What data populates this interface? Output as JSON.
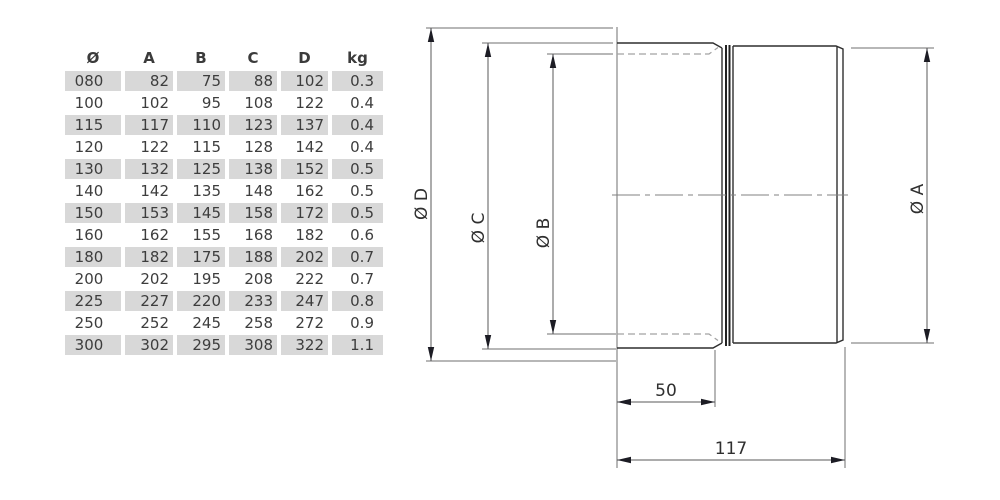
{
  "table": {
    "columns": [
      "Ø",
      "A",
      "B",
      "C",
      "D",
      "kg"
    ],
    "rows": [
      [
        "080",
        "82",
        "75",
        "88",
        "102",
        "0.3"
      ],
      [
        "100",
        "102",
        "95",
        "108",
        "122",
        "0.4"
      ],
      [
        "115",
        "117",
        "110",
        "123",
        "137",
        "0.4"
      ],
      [
        "120",
        "122",
        "115",
        "128",
        "142",
        "0.4"
      ],
      [
        "130",
        "132",
        "125",
        "138",
        "152",
        "0.5"
      ],
      [
        "140",
        "142",
        "135",
        "148",
        "162",
        "0.5"
      ],
      [
        "150",
        "153",
        "145",
        "158",
        "172",
        "0.5"
      ],
      [
        "160",
        "162",
        "155",
        "168",
        "182",
        "0.6"
      ],
      [
        "180",
        "182",
        "175",
        "188",
        "202",
        "0.7"
      ],
      [
        "200",
        "202",
        "195",
        "208",
        "222",
        "0.7"
      ],
      [
        "225",
        "227",
        "220",
        "233",
        "247",
        "0.8"
      ],
      [
        "250",
        "252",
        "245",
        "258",
        "272",
        "0.9"
      ],
      [
        "300",
        "302",
        "295",
        "308",
        "322",
        "1.1"
      ]
    ]
  },
  "drawing": {
    "labels": {
      "d": "Ø D",
      "c": "Ø C",
      "b": "Ø B",
      "a": "Ø A",
      "len50": "50",
      "len117": "117"
    }
  },
  "colors": {
    "row_shade": "#d8d8d8",
    "table_text": "#3d3d3d",
    "outline": "#2f2f2f",
    "dimension_line": "#5a5a5a",
    "extension_line": "#6f6f6f",
    "hidden_line": "#a2a2a2",
    "arrow": "#1c1c24",
    "background": "#ffffff"
  }
}
